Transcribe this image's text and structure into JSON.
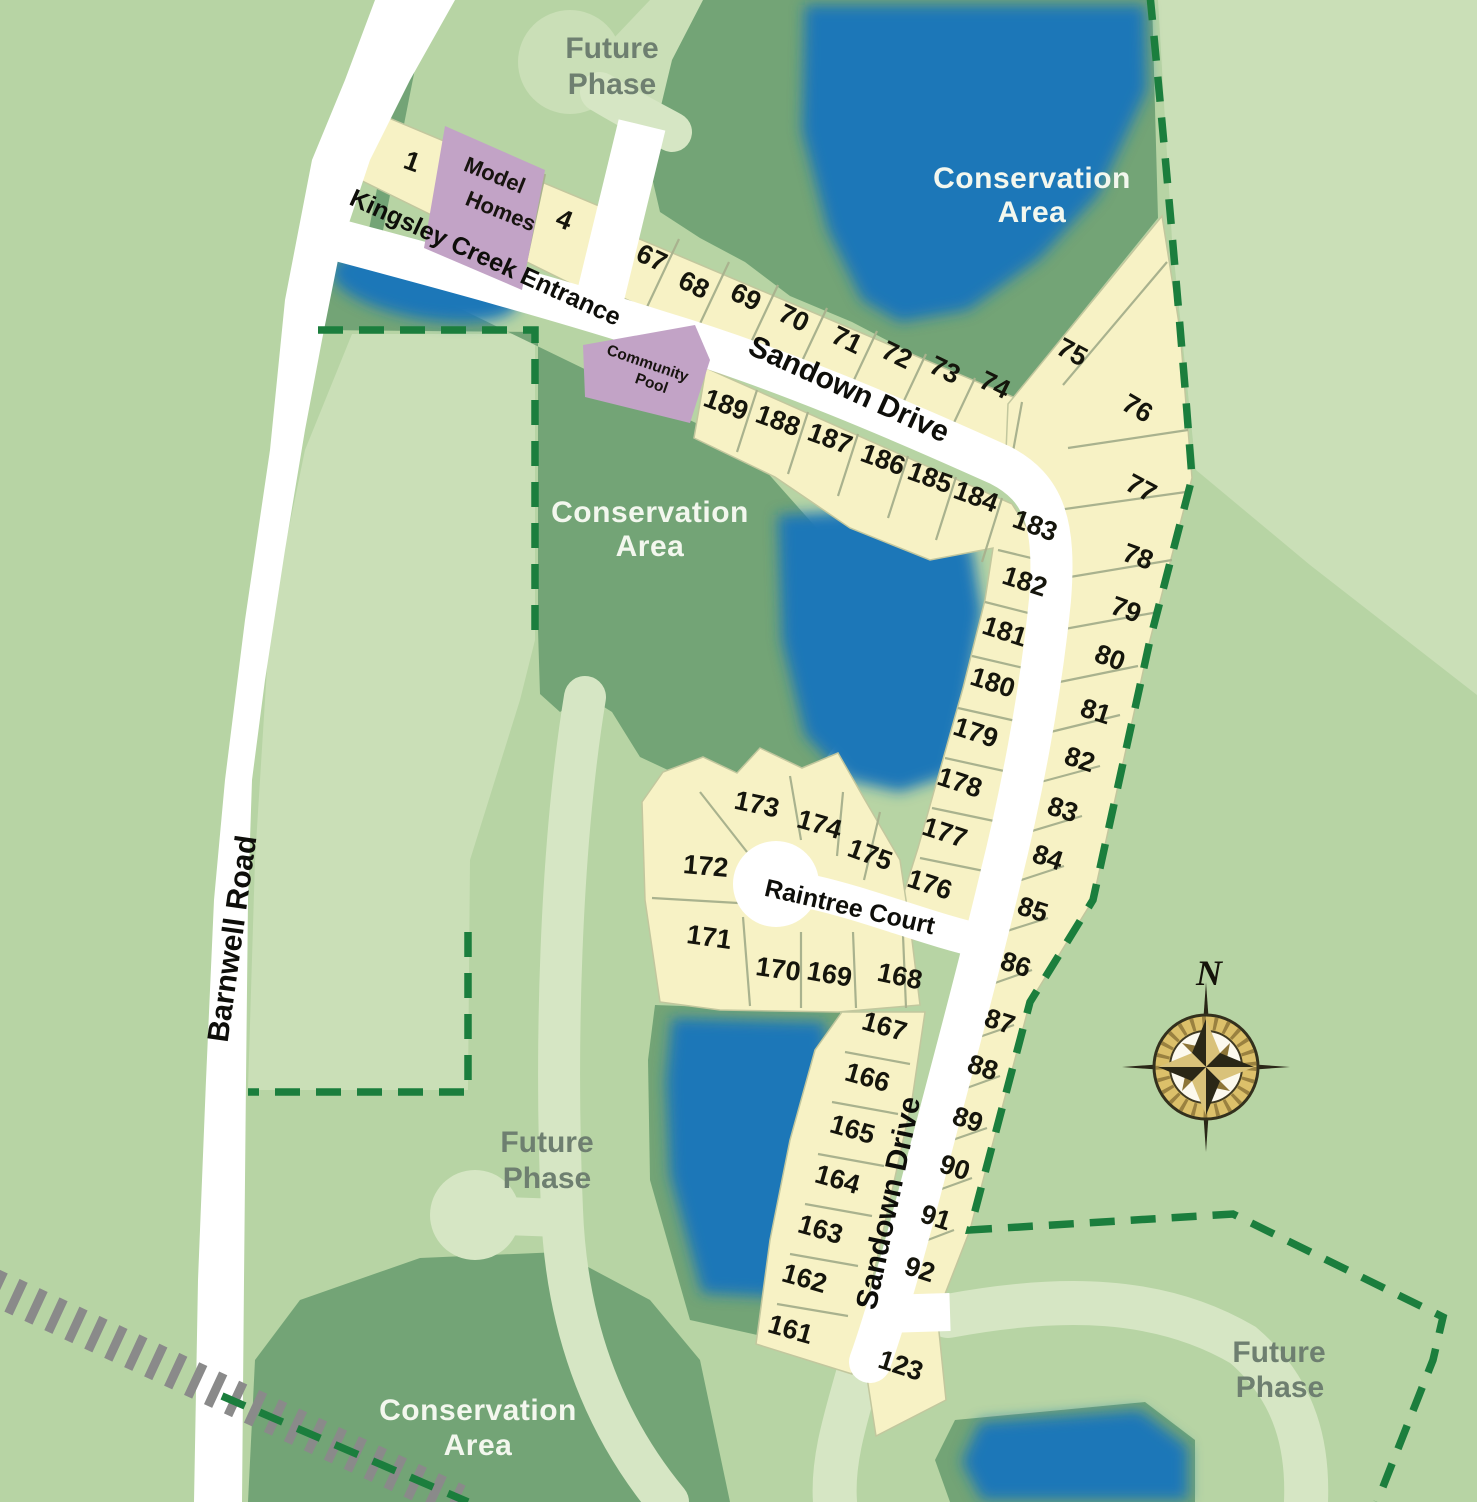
{
  "streets": {
    "barnwell_road": "Barnwell Road",
    "kingsley_creek_entrance": "Kingsley Creek Entrance",
    "sandown_drive_upper": "Sandown Drive",
    "sandown_drive_lower": "Sandown Drive",
    "raintree_court": "Raintree Court"
  },
  "areas": {
    "conservation_line1": "Conservation",
    "conservation_line2": "Area",
    "future_line1": "Future",
    "future_line2": "Phase"
  },
  "amenities": {
    "model_homes_line1": "Model",
    "model_homes_line2": "Homes",
    "community_pool_line1": "Community",
    "community_pool_line2": "Pool"
  },
  "compass": {
    "north": "N"
  },
  "lots": {
    "entry_row": [
      "1",
      "4"
    ],
    "north_row": [
      "67",
      "68",
      "69",
      "70",
      "71",
      "72",
      "73",
      "74"
    ],
    "northeast_fan": [
      "75",
      "76",
      "77"
    ],
    "east_column": [
      "78",
      "79",
      "80",
      "81",
      "82",
      "83",
      "84",
      "85",
      "86",
      "87",
      "88",
      "89",
      "90",
      "91",
      "92"
    ],
    "south_end": [
      "123"
    ],
    "inner_row": [
      "189",
      "188",
      "187",
      "186",
      "185",
      "184"
    ],
    "inner_column_upper": [
      "183",
      "182",
      "181",
      "180",
      "179",
      "178",
      "177",
      "176"
    ],
    "inner_column_lower": [
      "167",
      "166",
      "165",
      "164",
      "163",
      "162",
      "161"
    ],
    "raintree_north": [
      "173",
      "174",
      "175"
    ],
    "raintree_west": [
      "172",
      "171"
    ],
    "raintree_south": [
      "170",
      "169",
      "168"
    ]
  },
  "colors": {
    "background_green": "#b7d4a4",
    "future_phase_green": "#cadfb7",
    "path_green": "#d6e6c4",
    "conservation_green": "#73a476",
    "lot_yellow": "#f7f2c5",
    "lot_border": "#a9b28e",
    "road_white": "#ffffff",
    "amenity_purple": "#c2a3c6",
    "pond_blue": "#1f77b8",
    "boundary_dash_green": "#1b7e3d",
    "railroad_gray": "#8a8a8a",
    "future_label_gray": "#6e7f70"
  }
}
